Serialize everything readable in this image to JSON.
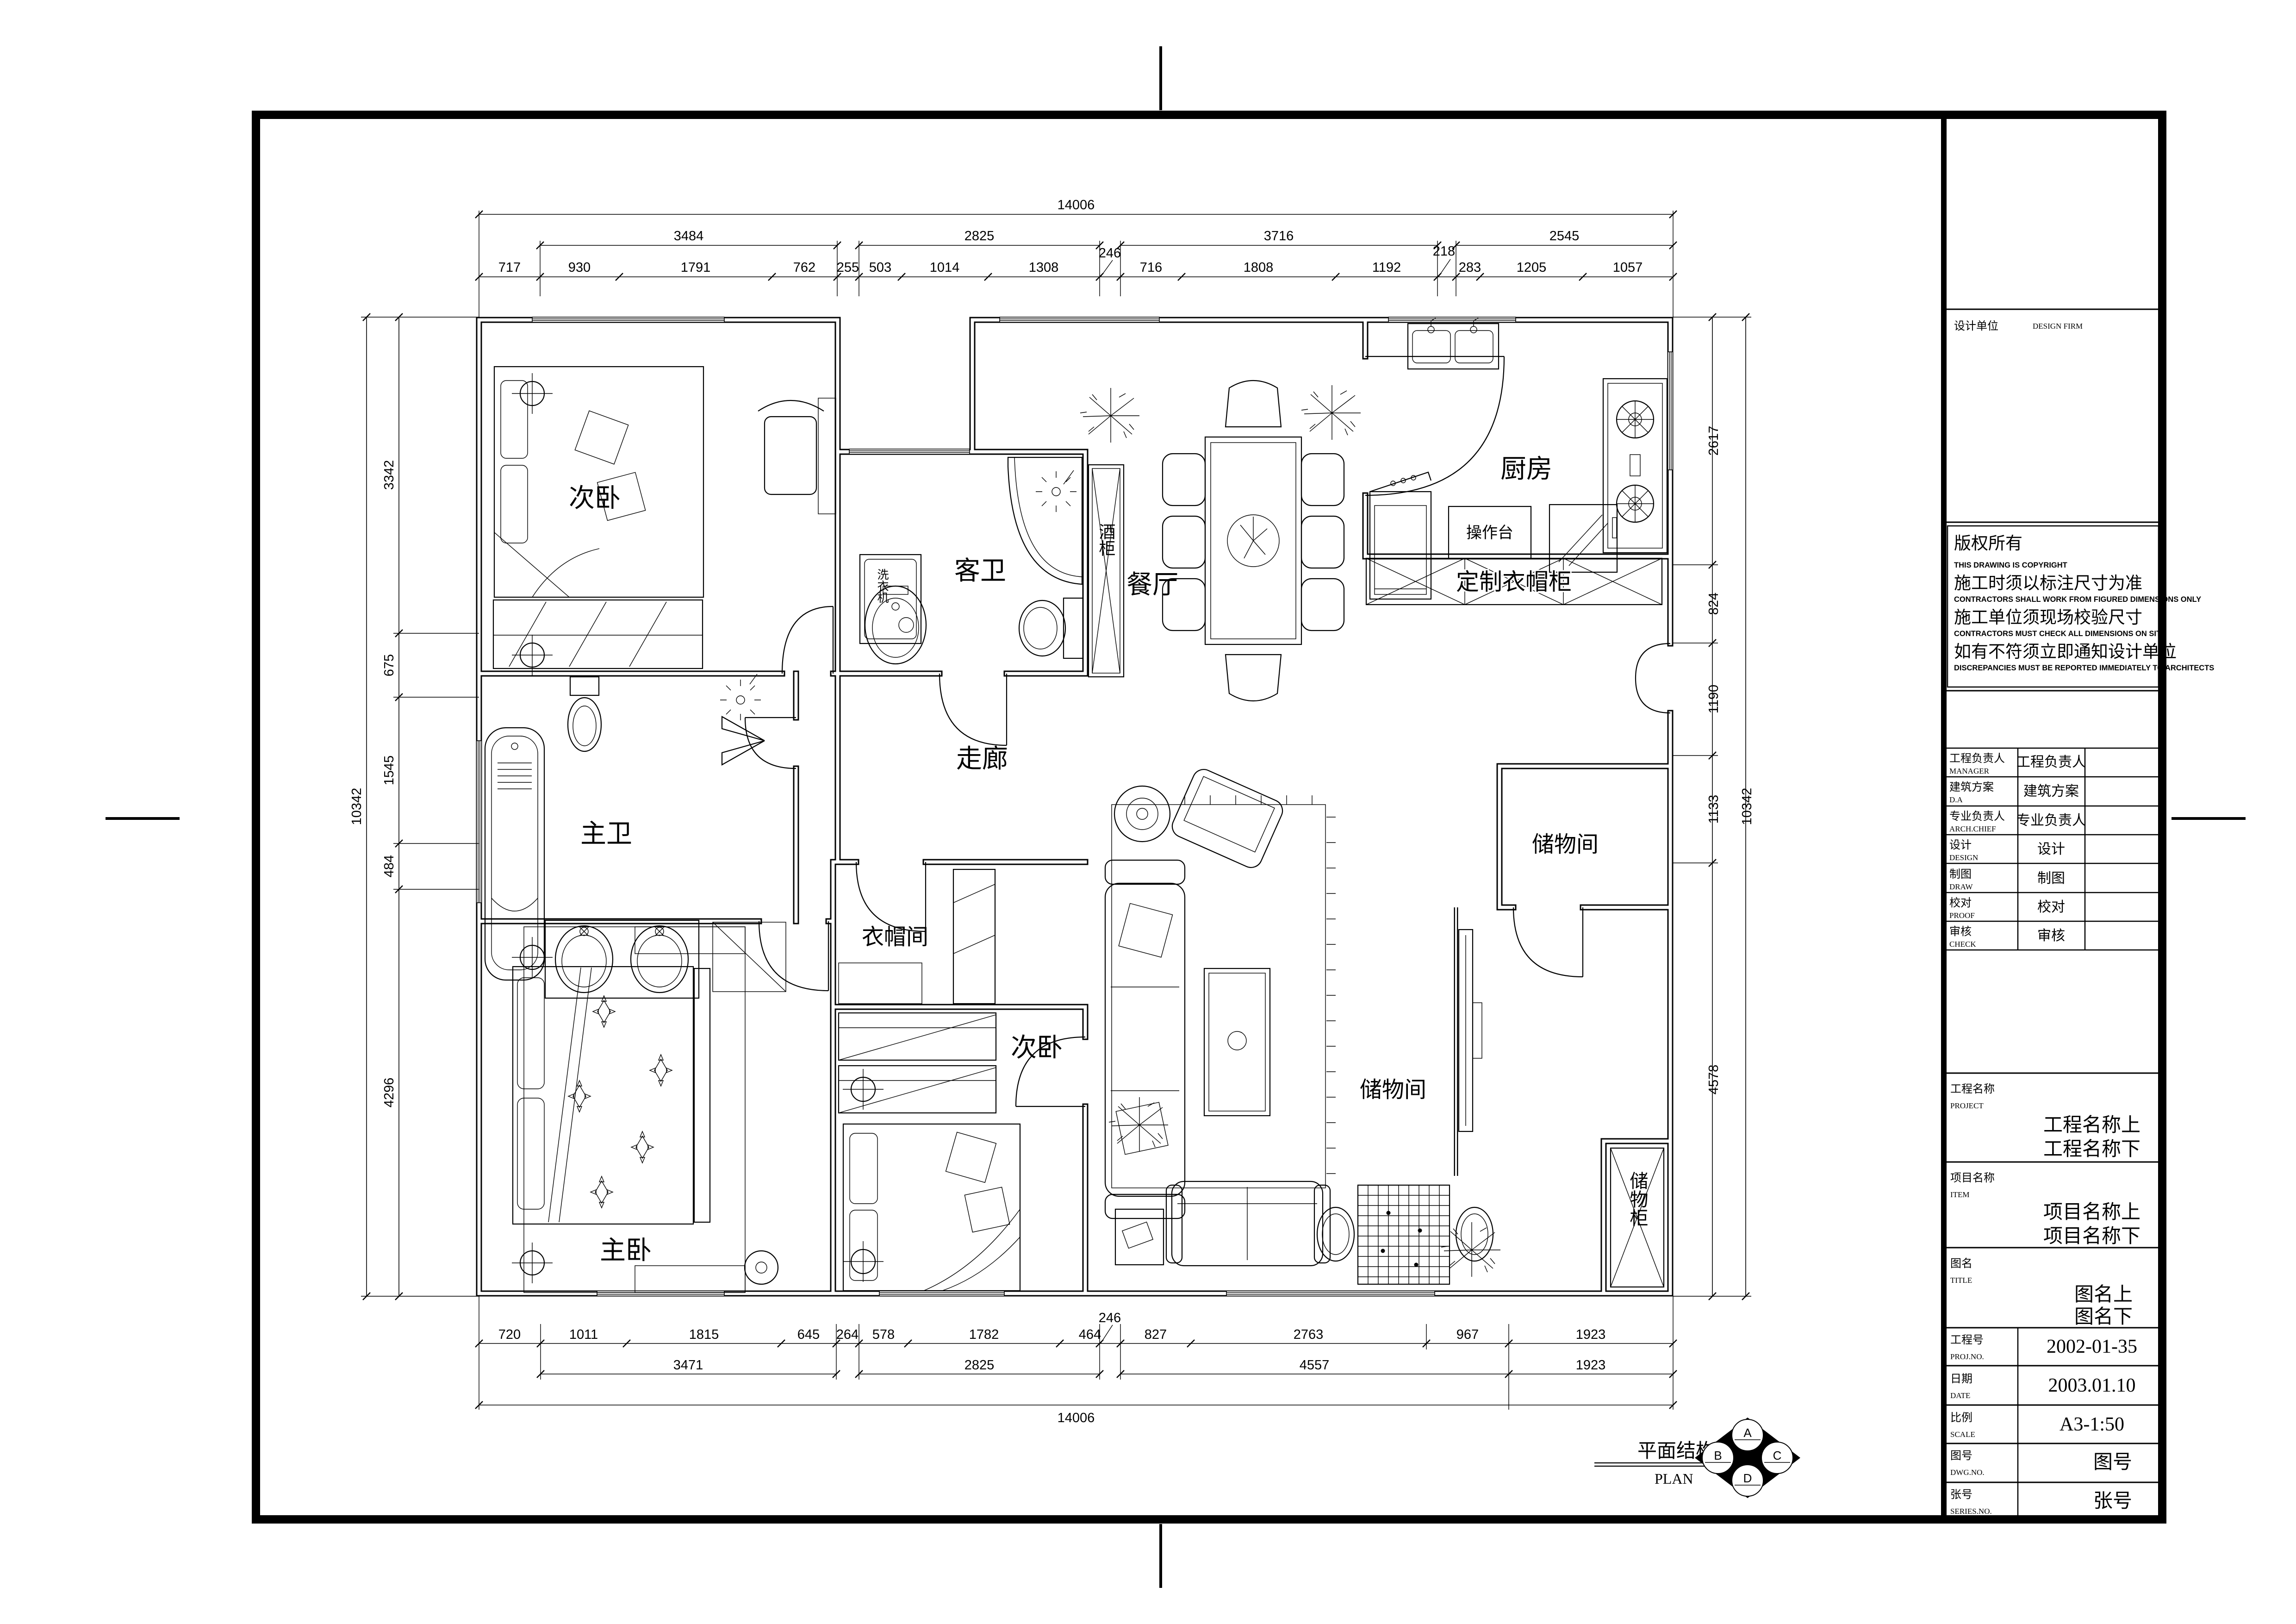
{
  "rooms": {
    "bedroom_tl": "次卧",
    "guest_bath": "客卫",
    "dining": "餐厅",
    "kitchen": "厨房",
    "master_bath": "主卫",
    "corridor": "走廊",
    "cloakroom": "衣帽间",
    "bedroom_b": "次卧",
    "master_bedroom": "主卧",
    "storage_tr": "储物间",
    "storage_mid": "储物间"
  },
  "fixtures": {
    "washing_machine": "洗衣机",
    "wine_cabinet": "酒柜",
    "counter": "操作台",
    "custom_wardrobe": "定制衣帽柜",
    "storage_cabinet": "储物柜"
  },
  "dims": {
    "top_total": "14006",
    "top_groups": [
      "3484",
      "2825",
      "3716",
      "2545"
    ],
    "top_detail": [
      "717",
      "930",
      "1791",
      "762",
      "255",
      "503",
      "1014",
      "1308",
      "246",
      "716",
      "1808",
      "1192",
      "218",
      "283",
      "1205",
      "1057"
    ],
    "bottom_total": "14006",
    "bottom_groups": [
      "3471",
      "2825",
      "4557",
      "1923"
    ],
    "bottom_detail": [
      "720",
      "1011",
      "1815",
      "645",
      "264",
      "578",
      "1782",
      "464",
      "246",
      "827",
      "2763",
      "967",
      "1923"
    ],
    "left_total": "10342",
    "left_detail": [
      "3342",
      "675",
      "1545",
      "484",
      "4296"
    ],
    "right_total": "10342",
    "right_detail": [
      "2617",
      "824",
      "1190",
      "1133",
      "4578"
    ]
  },
  "stamp": {
    "title_zh": "平面结构图",
    "title_en": "PLAN",
    "logo": [
      "A",
      "B",
      "C",
      "D"
    ]
  },
  "title_block": {
    "design_firm": {
      "zh": "设计单位",
      "en": "DESIGN FIRM"
    },
    "copyright": {
      "zh1": "版权所有",
      "en1": "THIS DRAWING IS COPYRIGHT",
      "zh2": "施工时须以标注尺寸为准",
      "en2": "CONTRACTORS SHALL WORK FROM FIGURED DIMENSIONS ONLY",
      "zh3": "施工单位须现场校验尺寸",
      "en3": "CONTRACTORS MUST CHECK ALL DIMENSIONS ON SITE",
      "zh4": "如有不符须立即通知设计单位",
      "en4": "DISCREPANCIES MUST BE REPORTED IMMEDIATELY TO ARCHITECTS"
    },
    "roles": [
      {
        "zh": "工程负责人",
        "en": "MANAGER",
        "value": "工程负责人"
      },
      {
        "zh": "建筑方案",
        "en": "D.A",
        "value": "建筑方案"
      },
      {
        "zh": "专业负责人",
        "en": "ARCH.CHIEF",
        "value": "专业负责人"
      },
      {
        "zh": "设计",
        "en": "DESIGN",
        "value": "设计"
      },
      {
        "zh": "制图",
        "en": "DRAW",
        "value": "制图"
      },
      {
        "zh": "校对",
        "en": "PROOF",
        "value": "校对"
      },
      {
        "zh": "审核",
        "en": "CHECK",
        "value": "审核"
      }
    ],
    "project": {
      "zh": "工程名称",
      "en": "PROJECT",
      "line1": "工程名称上",
      "line2": "工程名称下"
    },
    "item": {
      "zh": "项目名称",
      "en": "ITEM",
      "line1": "项目名称上",
      "line2": "项目名称下"
    },
    "drawing_title": {
      "zh": "图名",
      "en": "TITLE",
      "line1": "图名上",
      "line2": "图名下"
    },
    "proj_no": {
      "zh": "工程号",
      "en": "PROJ.NO.",
      "value": "2002-01-35"
    },
    "date": {
      "zh": "日期",
      "en": "DATE",
      "value": "2003.01.10"
    },
    "scale": {
      "zh": "比例",
      "en": "SCALE",
      "value": "A3-1:50"
    },
    "dwg_no": {
      "zh": "图号",
      "en": "DWG.NO.",
      "value": "图号"
    },
    "series_no": {
      "zh": "张号",
      "en": "SERIES.NO.",
      "value": "张号"
    }
  }
}
